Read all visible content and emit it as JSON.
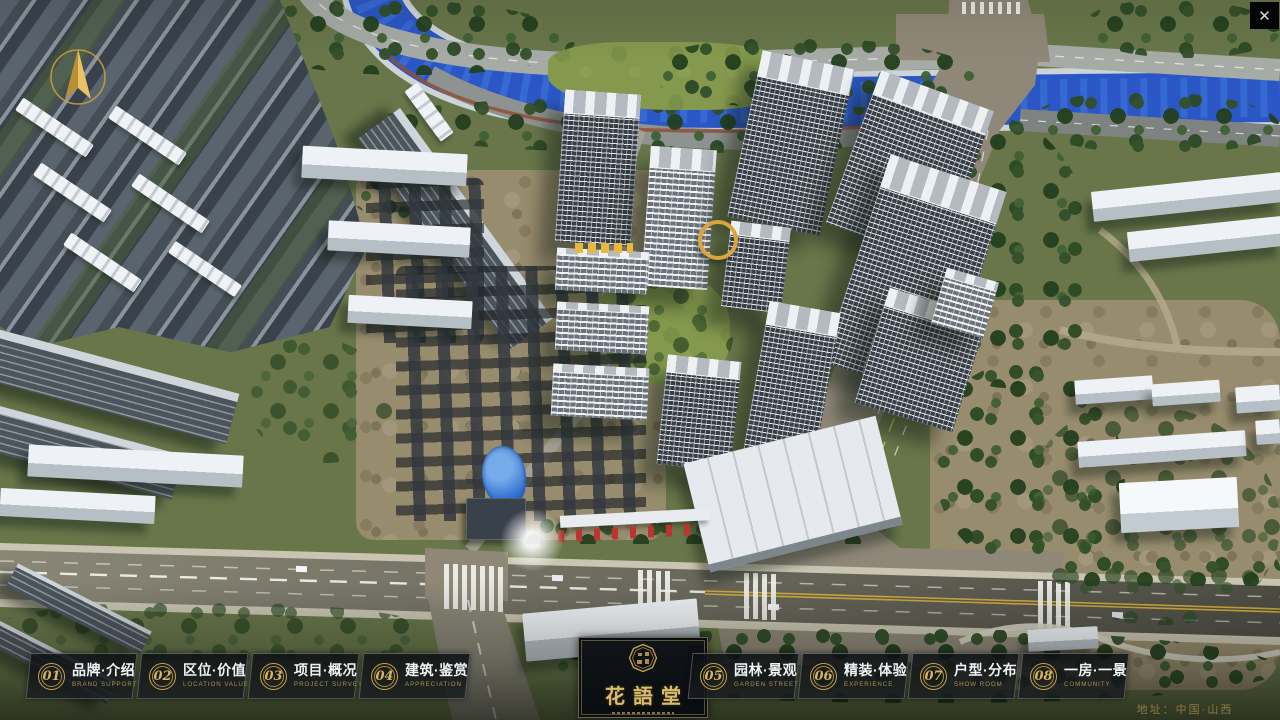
{
  "ui": {
    "close_glyph": "✕"
  },
  "logo": {
    "name": "花語堂"
  },
  "menu": {
    "items": [
      {
        "number": "01",
        "label": "品牌·介绍",
        "sublabel": "BRAND SUPPORT"
      },
      {
        "number": "02",
        "label": "区位·价值",
        "sublabel": "LOCATION VALUE"
      },
      {
        "number": "03",
        "label": "项目·概况",
        "sublabel": "PROJECT SURVEY"
      },
      {
        "number": "04",
        "label": "建筑·鉴赏",
        "sublabel": "APPRECIATION"
      },
      {
        "number": "05",
        "label": "园林·景观",
        "sublabel": "GARDEN STREET"
      },
      {
        "number": "06",
        "label": "精装·体验",
        "sublabel": "EXPERIENCE"
      },
      {
        "number": "07",
        "label": "户型·分布",
        "sublabel": "SHOW ROOM"
      },
      {
        "number": "08",
        "label": "一房·一景",
        "sublabel": "COMMUNITY"
      }
    ]
  },
  "footer": {
    "address": "地址：中国·山西"
  },
  "colors": {
    "accent_gold": "#c9a44e",
    "river_blue": "#2b57c6",
    "road_tan": "#8f8878",
    "asphalt": "#55534a"
  }
}
